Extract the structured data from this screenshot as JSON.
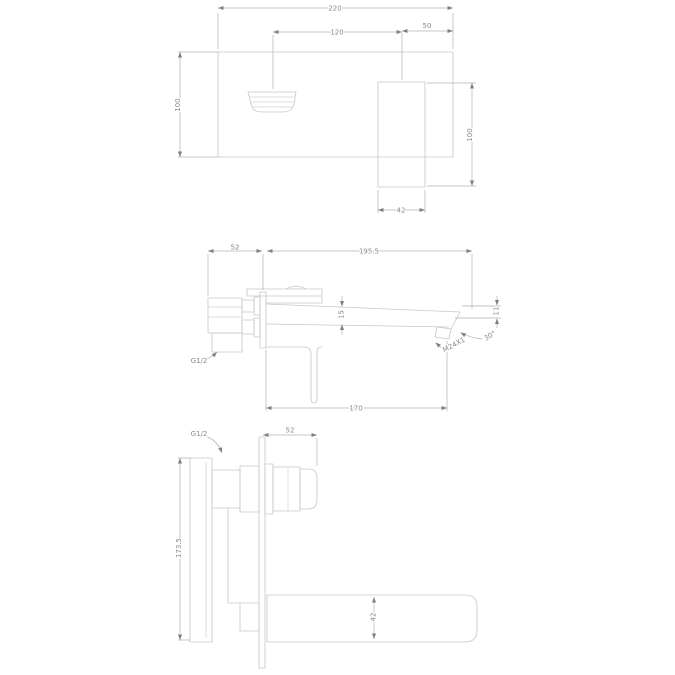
{
  "drawing": {
    "type": "technical-dimension-drawing",
    "subject": "wall-mounted basin mixer faucet",
    "colors": {
      "background": "#ffffff",
      "lines": "#c7c7c7",
      "dimension_lines": "#b0b0b0",
      "text": "#8a8a8a"
    },
    "views": {
      "front": {
        "label": "front-elevation",
        "dims": {
          "total_width": "220",
          "handle_to_spout": "120",
          "spout_to_edge": "50",
          "plate_height": "100",
          "spout_height": "100",
          "spout_width": "42"
        }
      },
      "plan": {
        "label": "plan-view",
        "dims": {
          "body_depth": "52",
          "spout_reach": "195.5",
          "spout_mid_height": "15",
          "spout_tip_height": "11",
          "tip_angle": "30°",
          "aerator_thread": "M24X1",
          "wall_to_aerator": "170",
          "inlet_thread": "G1/2"
        }
      },
      "side": {
        "label": "side-elevation",
        "dims": {
          "handle_depth": "52",
          "body_height": "173.5",
          "spout_section": "42",
          "inlet_thread": "G1/2"
        }
      }
    }
  }
}
